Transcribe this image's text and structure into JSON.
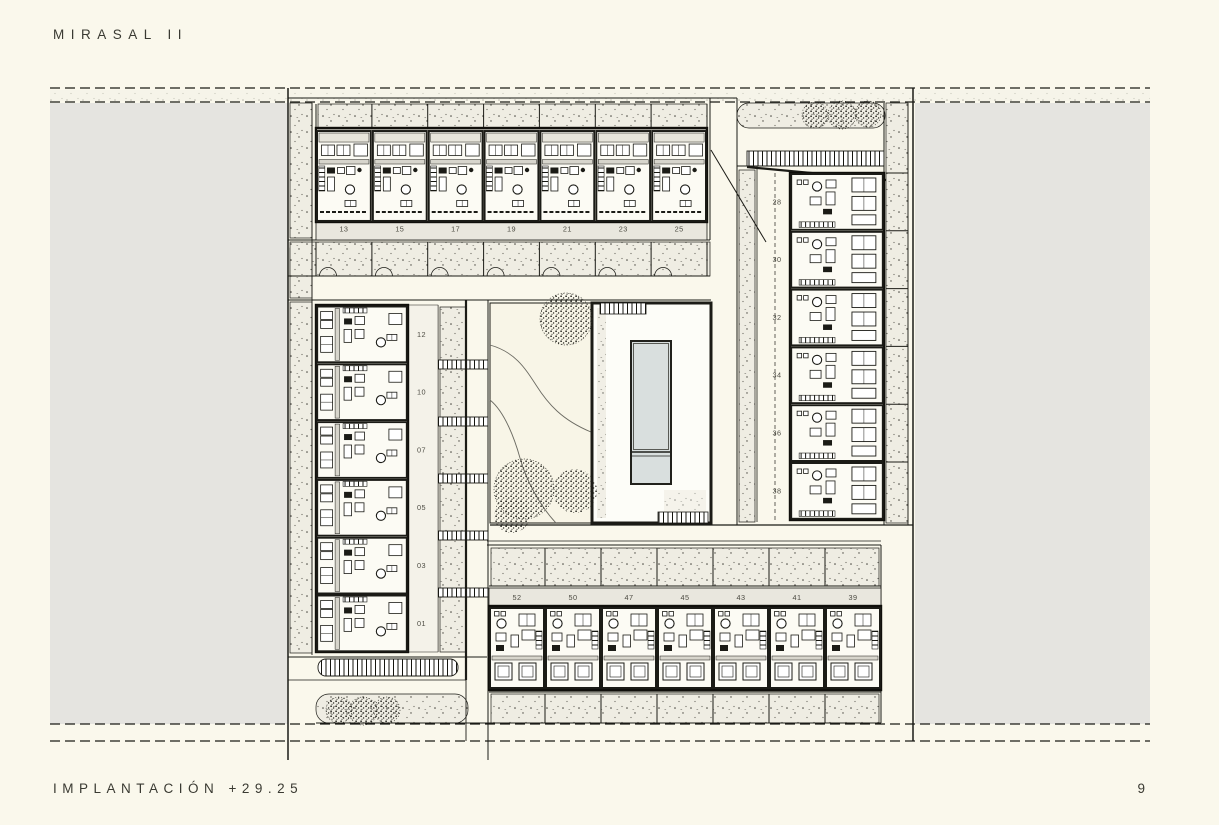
{
  "page": {
    "title": "MIRASAL II",
    "footer_label": "IMPLANTACIÓN +29.25",
    "page_number": "9",
    "colors": {
      "bg": "#faf8ec",
      "mask": "#e5e4e0",
      "line": "#1b1b16",
      "ink": "#3a3a32",
      "pool": "#d9dfde",
      "stipple": "#efede3",
      "label": "#e9e7de"
    }
  },
  "plan": {
    "name": "site-plan-implantacion",
    "level": "+29.25",
    "groups": [
      {
        "id": "top-row",
        "orientation": "row-top",
        "units": [
          "13",
          "15",
          "17",
          "19",
          "21",
          "23",
          "25"
        ]
      },
      {
        "id": "left-column",
        "orientation": "column-left",
        "units": [
          "12",
          "10",
          "07",
          "05",
          "03",
          "01"
        ]
      },
      {
        "id": "right-column",
        "orientation": "column-right",
        "units": [
          "28",
          "30",
          "32",
          "34",
          "36",
          "38"
        ]
      },
      {
        "id": "bottom-row",
        "orientation": "row-bottom",
        "units": [
          "52",
          "50",
          "47",
          "45",
          "43",
          "41",
          "39"
        ]
      }
    ]
  }
}
